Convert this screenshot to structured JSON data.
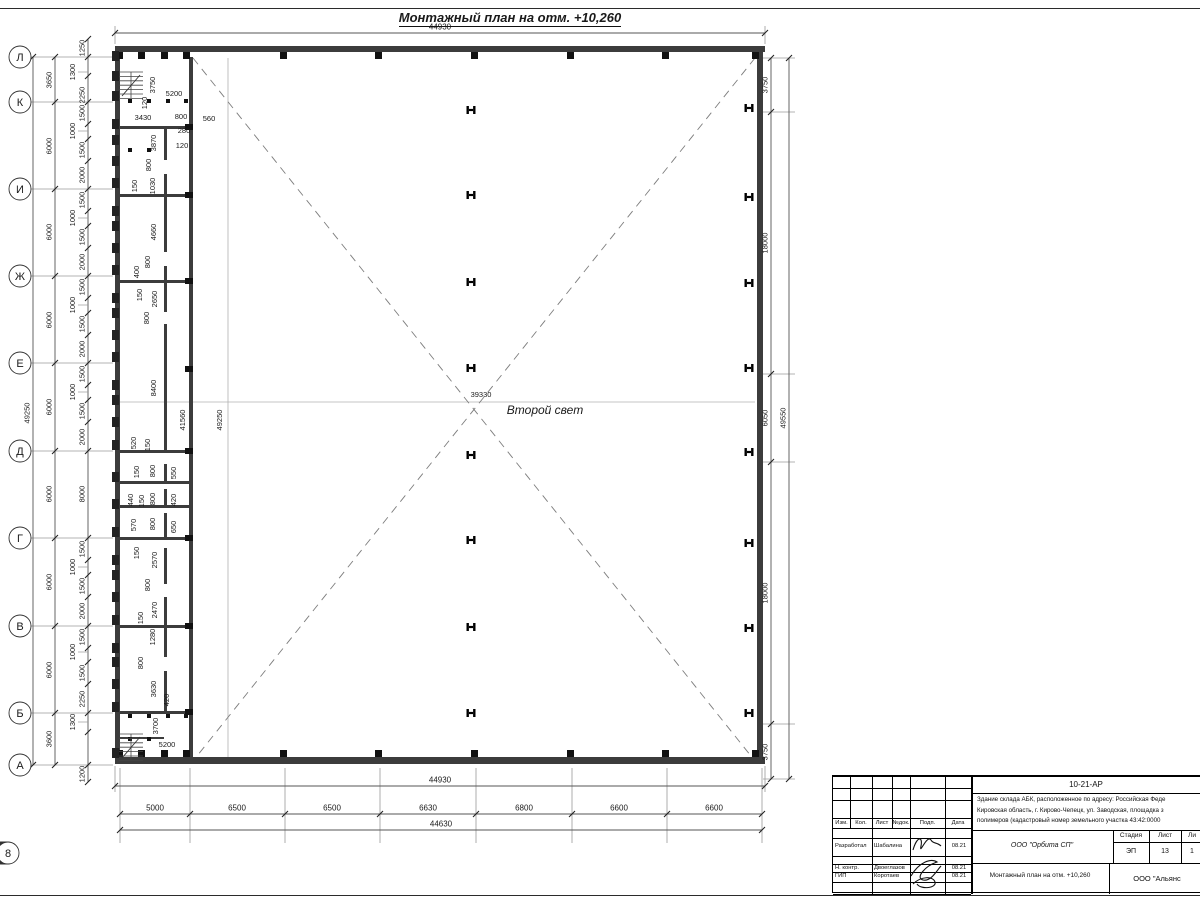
{
  "title": "Монтажный план на отм. +10,260",
  "hall": {
    "second_light": "Второй свет",
    "width_label": "39330",
    "height_label": "49250",
    "inner_height_label": "41560"
  },
  "axes": {
    "rows": [
      [
        "Л",
        57
      ],
      [
        "К",
        102
      ],
      [
        "И",
        189
      ],
      [
        "Ж",
        276
      ],
      [
        "Е",
        363
      ],
      [
        "Д",
        451
      ],
      [
        "Г",
        538
      ],
      [
        "В",
        626
      ],
      [
        "Б",
        713
      ],
      [
        "А",
        765
      ]
    ],
    "cols": [
      [
        "1",
        120
      ],
      [
        "2",
        190
      ],
      [
        "3",
        285
      ],
      [
        "4",
        380
      ],
      [
        "5",
        476
      ],
      [
        "6",
        572
      ],
      [
        "7",
        667
      ],
      [
        "8",
        762
      ]
    ]
  },
  "chains": [
    {
      "o": "h",
      "y": 33,
      "x1": 115,
      "x2": 765,
      "ticks": [
        115,
        765
      ],
      "labels": [
        {
          "t": "44930",
          "at": 440
        }
      ]
    },
    {
      "o": "h",
      "y": 786,
      "x1": 115,
      "x2": 765,
      "ticks": [
        115,
        765
      ],
      "labels": [
        {
          "t": "44930",
          "at": 440
        }
      ]
    },
    {
      "o": "h",
      "y": 814,
      "x1": 120,
      "x2": 762,
      "ticks": [
        120,
        190,
        285,
        380,
        476,
        572,
        667,
        762
      ],
      "labels": [
        {
          "t": "5000",
          "at": 155
        },
        {
          "t": "6500",
          "at": 237
        },
        {
          "t": "6500",
          "at": 332
        },
        {
          "t": "6630",
          "at": 428
        },
        {
          "t": "6800",
          "at": 524
        },
        {
          "t": "6600",
          "at": 619
        },
        {
          "t": "6600",
          "at": 714
        }
      ]
    },
    {
      "o": "h",
      "y": 830,
      "x1": 120,
      "x2": 762,
      "ticks": [
        120,
        762
      ],
      "labels": [
        {
          "t": "44630",
          "at": 441
        }
      ]
    },
    {
      "o": "v",
      "x": 55,
      "y1": 57,
      "y2": 765,
      "ticks": [
        57,
        102,
        189,
        276,
        363,
        451,
        538,
        626,
        713,
        765
      ],
      "labels": [
        {
          "t": "3650",
          "at": 80
        },
        {
          "t": "6000",
          "at": 146
        },
        {
          "t": "6000",
          "at": 232
        },
        {
          "t": "6000",
          "at": 320
        },
        {
          "t": "6000",
          "at": 407
        },
        {
          "t": "6000",
          "at": 494
        },
        {
          "t": "6000",
          "at": 582
        },
        {
          "t": "6000",
          "at": 670
        },
        {
          "t": "3600",
          "at": 739
        }
      ]
    },
    {
      "o": "v",
      "x": 33,
      "y1": 57,
      "y2": 765,
      "ticks": [
        57,
        765
      ],
      "labels": [
        {
          "t": "49250",
          "at": 413
        }
      ]
    },
    {
      "o": "v",
      "x": 88,
      "y1": 39,
      "y2": 782,
      "ticks": [
        39,
        57,
        76,
        102,
        124,
        139,
        161,
        189,
        211,
        226,
        248,
        276,
        298,
        313,
        335,
        363,
        385,
        400,
        422,
        451,
        538,
        560,
        575,
        597,
        626,
        648,
        662,
        684,
        713,
        732,
        765,
        782
      ],
      "labels": [
        {
          "t": "1250",
          "at": 48
        },
        {
          "t": "1300",
          "at": 72,
          "ld": 1
        },
        {
          "t": "2250",
          "at": 95
        },
        {
          "t": "1500",
          "at": 113
        },
        {
          "t": "1000",
          "at": 131,
          "ld": 1
        },
        {
          "t": "1500",
          "at": 150
        },
        {
          "t": "2000",
          "at": 175
        },
        {
          "t": "1500",
          "at": 200
        },
        {
          "t": "1000",
          "at": 218,
          "ld": 1
        },
        {
          "t": "1500",
          "at": 237
        },
        {
          "t": "2000",
          "at": 262
        },
        {
          "t": "1500",
          "at": 287
        },
        {
          "t": "1000",
          "at": 305,
          "ld": 1
        },
        {
          "t": "1500",
          "at": 324
        },
        {
          "t": "2000",
          "at": 349
        },
        {
          "t": "1500",
          "at": 374
        },
        {
          "t": "1000",
          "at": 392,
          "ld": 1
        },
        {
          "t": "1500",
          "at": 411
        },
        {
          "t": "2000",
          "at": 437
        },
        {
          "t": "8000",
          "at": 494
        },
        {
          "t": "1500",
          "at": 549
        },
        {
          "t": "1000",
          "at": 567,
          "ld": 1
        },
        {
          "t": "1500",
          "at": 586
        },
        {
          "t": "2000",
          "at": 611
        },
        {
          "t": "1500",
          "at": 637
        },
        {
          "t": "1000",
          "at": 652,
          "ld": 1
        },
        {
          "t": "1500",
          "at": 673
        },
        {
          "t": "2250",
          "at": 699
        },
        {
          "t": "1300",
          "at": 722,
          "ld": 1
        },
        {
          "t": "1200",
          "at": 774
        }
      ]
    },
    {
      "o": "v",
      "x": 771,
      "y1": 58,
      "y2": 779,
      "ticks": [
        58,
        112,
        374,
        462,
        724,
        779
      ],
      "labels": [
        {
          "t": "3750",
          "at": 85
        },
        {
          "t": "18000",
          "at": 243
        },
        {
          "t": "6050",
          "at": 418
        },
        {
          "t": "18000",
          "at": 593
        },
        {
          "t": "3750",
          "at": 752
        }
      ]
    },
    {
      "o": "v",
      "x": 789,
      "y1": 58,
      "y2": 779,
      "ticks": [
        58,
        779
      ],
      "labels": [
        {
          "t": "49550",
          "at": 418
        }
      ]
    }
  ],
  "dim_labels": [
    {
      "t": "3750",
      "x": 155,
      "y": 85,
      "r": 1
    },
    {
      "t": "120",
      "x": 147,
      "y": 103,
      "r": 1
    },
    {
      "t": "5200",
      "x": 174,
      "y": 96
    },
    {
      "t": "3430",
      "x": 143,
      "y": 120
    },
    {
      "t": "800",
      "x": 181,
      "y": 119
    },
    {
      "t": "560",
      "x": 209,
      "y": 121
    },
    {
      "t": "280",
      "x": 184,
      "y": 133
    },
    {
      "t": "120",
      "x": 182,
      "y": 148
    },
    {
      "t": "3870",
      "x": 156,
      "y": 143,
      "r": 1
    },
    {
      "t": "800",
      "x": 151,
      "y": 165,
      "r": 1
    },
    {
      "t": "150",
      "x": 137,
      "y": 186,
      "r": 1
    },
    {
      "t": "1030",
      "x": 155,
      "y": 186,
      "r": 1
    },
    {
      "t": "4660",
      "x": 156,
      "y": 232,
      "r": 1
    },
    {
      "t": "800",
      "x": 150,
      "y": 262,
      "r": 1
    },
    {
      "t": "400",
      "x": 139,
      "y": 272,
      "r": 1
    },
    {
      "t": "150",
      "x": 142,
      "y": 295,
      "r": 1
    },
    {
      "t": "2650",
      "x": 157,
      "y": 299,
      "r": 1
    },
    {
      "t": "800",
      "x": 149,
      "y": 318,
      "r": 1
    },
    {
      "t": "8400",
      "x": 156,
      "y": 388,
      "r": 1
    },
    {
      "t": "520",
      "x": 136,
      "y": 443,
      "r": 1
    },
    {
      "t": "150",
      "x": 150,
      "y": 445,
      "r": 1
    },
    {
      "t": "150",
      "x": 139,
      "y": 472,
      "r": 1
    },
    {
      "t": "800",
      "x": 155,
      "y": 471,
      "r": 1
    },
    {
      "t": "550",
      "x": 176,
      "y": 473,
      "r": 1
    },
    {
      "t": "440",
      "x": 133,
      "y": 500,
      "r": 1
    },
    {
      "t": "150",
      "x": 144,
      "y": 501,
      "r": 1
    },
    {
      "t": "800",
      "x": 155,
      "y": 499,
      "r": 1
    },
    {
      "t": "420",
      "x": 176,
      "y": 500,
      "r": 1
    },
    {
      "t": "570",
      "x": 136,
      "y": 525,
      "r": 1
    },
    {
      "t": "800",
      "x": 155,
      "y": 524,
      "r": 1
    },
    {
      "t": "650",
      "x": 176,
      "y": 527,
      "r": 1
    },
    {
      "t": "150",
      "x": 139,
      "y": 553,
      "r": 1
    },
    {
      "t": "2570",
      "x": 157,
      "y": 560,
      "r": 1
    },
    {
      "t": "800",
      "x": 150,
      "y": 585,
      "r": 1
    },
    {
      "t": "2470",
      "x": 157,
      "y": 610,
      "r": 1
    },
    {
      "t": "150",
      "x": 143,
      "y": 618,
      "r": 1
    },
    {
      "t": "1280",
      "x": 155,
      "y": 637,
      "r": 1
    },
    {
      "t": "800",
      "x": 143,
      "y": 663,
      "r": 1
    },
    {
      "t": "3630",
      "x": 156,
      "y": 689,
      "r": 1
    },
    {
      "t": "420",
      "x": 169,
      "y": 700,
      "r": 1
    },
    {
      "t": "3700",
      "x": 158,
      "y": 726,
      "r": 1
    },
    {
      "t": "5200",
      "x": 167,
      "y": 747
    },
    {
      "t": "41560",
      "x": 185,
      "y": 420,
      "r": 1
    },
    {
      "t": "49250",
      "x": 222,
      "y": 420,
      "r": 1
    },
    {
      "t": "39330",
      "x": 481,
      "y": 397
    }
  ],
  "plan": {
    "walls": [
      [
        115,
        46,
        650,
        6
      ],
      [
        115,
        757,
        650,
        7
      ],
      [
        757,
        52,
        6,
        705
      ],
      [
        115,
        52,
        5,
        705
      ],
      [
        189,
        57,
        4,
        700
      ],
      [
        119,
        126,
        70,
        3
      ],
      [
        119,
        194,
        70,
        3
      ],
      [
        119,
        280,
        70,
        3
      ],
      [
        119,
        450,
        70,
        3
      ],
      [
        119,
        481,
        70,
        3
      ],
      [
        119,
        505,
        70,
        3
      ],
      [
        119,
        537,
        70,
        3
      ],
      [
        119,
        625,
        70,
        3
      ],
      [
        119,
        711,
        70,
        3
      ],
      [
        119,
        737,
        45,
        2
      ],
      [
        164,
        126,
        3,
        34
      ],
      [
        164,
        174,
        3,
        78
      ],
      [
        164,
        266,
        3,
        46
      ],
      [
        164,
        324,
        3,
        126
      ],
      [
        164,
        464,
        3,
        17
      ],
      [
        164,
        489,
        3,
        16
      ],
      [
        164,
        513,
        3,
        24
      ],
      [
        164,
        548,
        3,
        36
      ],
      [
        164,
        597,
        3,
        60
      ],
      [
        164,
        671,
        3,
        40
      ]
    ],
    "squares": [
      [
        283,
        52
      ],
      [
        378,
        52
      ],
      [
        474,
        52
      ],
      [
        570,
        52
      ],
      [
        665,
        52
      ],
      [
        755,
        52
      ],
      [
        119,
        52
      ],
      [
        141,
        52
      ],
      [
        164,
        52
      ],
      [
        186,
        52
      ],
      [
        283,
        750
      ],
      [
        378,
        750
      ],
      [
        474,
        750
      ],
      [
        570,
        750
      ],
      [
        665,
        750
      ],
      [
        755,
        750
      ],
      [
        119,
        750
      ],
      [
        141,
        750
      ],
      [
        164,
        750
      ],
      [
        186,
        750
      ]
    ],
    "dots": [
      [
        130,
        101
      ],
      [
        149,
        101
      ],
      [
        168,
        101
      ],
      [
        186,
        101
      ],
      [
        130,
        150
      ],
      [
        149,
        150
      ],
      [
        130,
        716
      ],
      [
        149,
        716
      ],
      [
        168,
        716
      ],
      [
        186,
        716
      ],
      [
        130,
        739
      ],
      [
        149,
        739
      ]
    ],
    "pilaster_ys": [
      56,
      76,
      96,
      124,
      140,
      161,
      183,
      211,
      226,
      248,
      270,
      298,
      313,
      335,
      357,
      385,
      400,
      422,
      445,
      477,
      504,
      532,
      560,
      575,
      597,
      620,
      648,
      662,
      684,
      707,
      753
    ],
    "hcols_center": {
      "x": 471,
      "ys": [
        110,
        195,
        282,
        368,
        455,
        540,
        627,
        713
      ]
    },
    "hcols_right": {
      "x": 749,
      "ys": [
        108,
        197,
        283,
        368,
        452,
        543,
        628,
        713
      ]
    },
    "tjoint_ys": [
      126,
      194,
      280,
      368,
      450,
      537,
      625,
      711
    ],
    "stairs": [
      {
        "x": 119,
        "y": 72
      },
      {
        "x": 119,
        "y": 734
      }
    ],
    "diagonals": [
      [
        193,
        58,
        755,
        761
      ],
      [
        755,
        58,
        193,
        761
      ]
    ],
    "centerlines": [
      [
        228,
        58,
        228,
        761
      ],
      [
        117,
        402,
        755,
        402
      ]
    ],
    "thin_lines": [
      [
        31,
        57,
        113,
        57
      ],
      [
        31,
        102,
        113,
        102
      ],
      [
        31,
        189,
        113,
        189
      ],
      [
        31,
        276,
        113,
        276
      ],
      [
        31,
        363,
        113,
        363
      ],
      [
        31,
        451,
        113,
        451
      ],
      [
        31,
        538,
        113,
        538
      ],
      [
        31,
        626,
        113,
        626
      ],
      [
        31,
        713,
        113,
        713
      ],
      [
        31,
        765,
        113,
        765
      ],
      [
        120,
        768,
        120,
        843
      ],
      [
        190,
        768,
        190,
        843
      ],
      [
        285,
        768,
        285,
        843
      ],
      [
        380,
        768,
        380,
        843
      ],
      [
        476,
        768,
        476,
        843
      ],
      [
        572,
        768,
        572,
        843
      ],
      [
        667,
        768,
        667,
        843
      ],
      [
        762,
        768,
        762,
        843
      ],
      [
        763,
        58,
        795,
        58
      ],
      [
        763,
        112,
        795,
        112
      ],
      [
        763,
        374,
        795,
        374
      ],
      [
        763,
        462,
        795,
        462
      ],
      [
        763,
        724,
        795,
        724
      ],
      [
        763,
        779,
        795,
        779
      ],
      [
        115,
        44,
        115,
        26
      ],
      [
        765,
        44,
        765,
        26
      ],
      [
        115,
        766,
        115,
        792
      ],
      [
        765,
        766,
        765,
        792
      ]
    ]
  },
  "titleblock": {
    "left": {
      "header": [
        "Изм.",
        "Кол.",
        "Лист",
        "№док.",
        "Подп.",
        "Дата"
      ],
      "entries": [
        {
          "role": "Разработал",
          "name": "Шабалина",
          "date": "08.21"
        },
        {
          "role": "Н. контр.",
          "name": "Двоеглазов",
          "date": "08.21"
        },
        {
          "role": "ГИП",
          "name": "Коротаев",
          "date": "08.21"
        }
      ]
    },
    "right": {
      "code": "10-21-АР",
      "desc": [
        "Здание склада АБК, расположенное по адресу: Российская Феде",
        "Кировская область, г. Кирово-Чепецк, ул. Заводская, площадка з",
        "полимеров (кадастровый номер земельного участка 43:42:0000"
      ],
      "org": "ООО \"Орбита СП\"",
      "stage_header": [
        "Стадия",
        "Лист",
        "Ли"
      ],
      "stage_values": [
        "ЭП",
        "13",
        "1"
      ],
      "sheet_title": "Монтажный план на отм. +10,260",
      "org2": "ООО \"Альянс"
    }
  }
}
